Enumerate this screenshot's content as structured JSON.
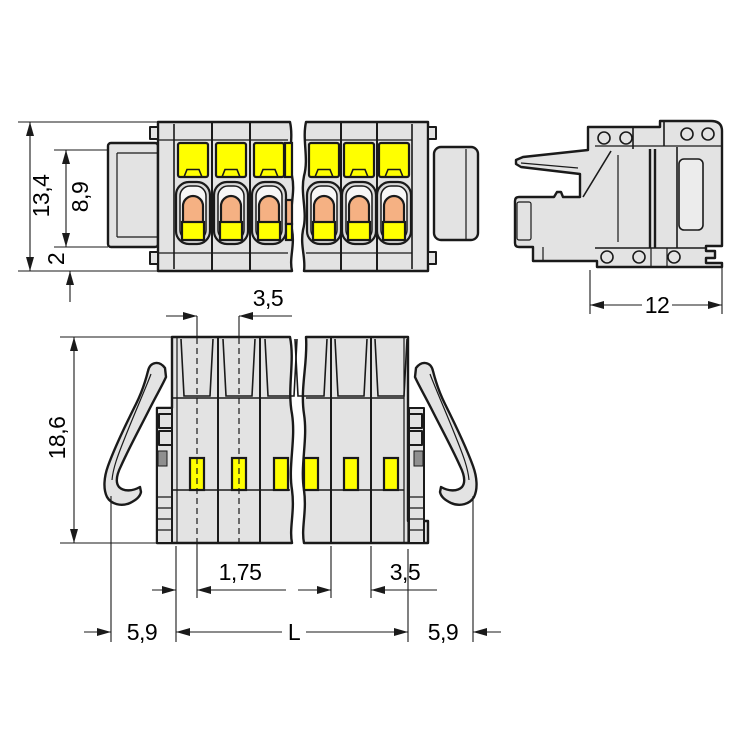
{
  "drawing": {
    "type": "technical-dimension-drawing",
    "subject": "multi-pole pluggable terminal block connector, 3 orthographic views (broken view)",
    "dimensions": {
      "overall_height": "13,4",
      "tab_height": "8,9",
      "base_offset": "2",
      "pole_pitch_top": "3,5",
      "side_depth": "12",
      "front_height": "18,6",
      "half_pitch": "1,75",
      "pole_pitch_bottom": "3,5",
      "latch_overhang_left": "5,9",
      "length_symbol": "L",
      "latch_overhang_right": "5,9"
    },
    "colors": {
      "housing_gray": "#e3e3e3",
      "detail_gray": "#dadada",
      "ring_white": "#f7f7f7",
      "pushbutton_yellow": "#ffff00",
      "lever_orange": "#f5b183",
      "outline_black": "#1a1a1a",
      "metal_gray": "#8f8f8f",
      "background": "#ffffff"
    }
  }
}
